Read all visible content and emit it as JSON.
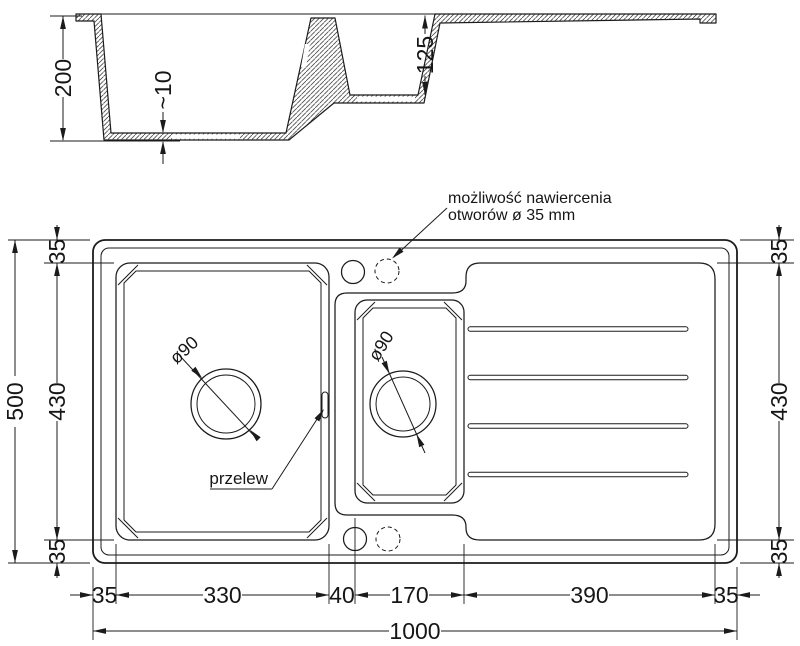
{
  "section": {
    "depth_main": "200",
    "floor_thickness": "~10",
    "depth_small": "125"
  },
  "plan": {
    "annotation_line1": "możliwość nawiercenia",
    "annotation_line2": "otworów ø 35 mm",
    "overflow_label": "przelew",
    "drain_main_label": "ø90",
    "drain_small_label": "ø90",
    "dims": {
      "overall_width": "1000",
      "overall_height": "500",
      "left_chain": [
        "35",
        "430",
        "35"
      ],
      "right_chain": [
        "35",
        "430",
        "35"
      ],
      "bottom_chain": [
        "35",
        "330",
        "40",
        "170",
        "390",
        "35"
      ]
    }
  },
  "colors": {
    "line": "#1b1b1b",
    "background": "#ffffff"
  }
}
